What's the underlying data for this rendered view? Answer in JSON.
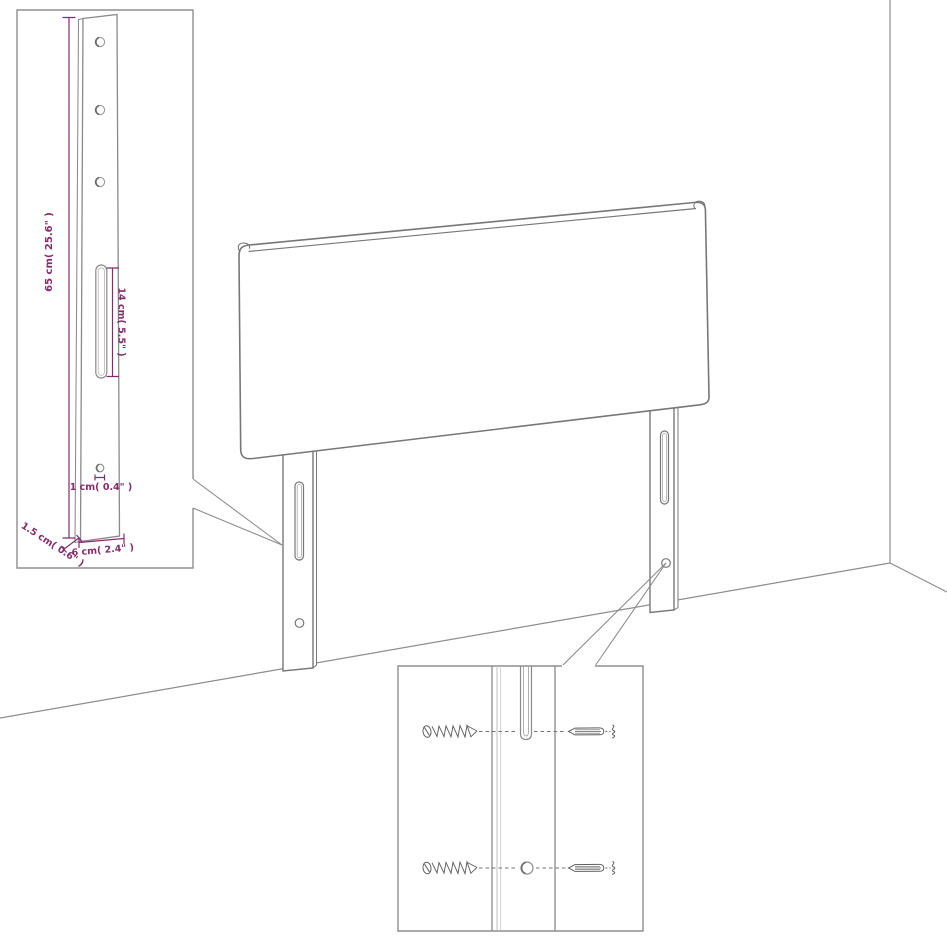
{
  "page": {
    "background": "#ffffff",
    "subject": "headboard-mounting-diagram"
  },
  "colors": {
    "drawing_line": "#777777",
    "wall_line": "#8d8d8d",
    "inset_border": "#8f8f8f",
    "dimension_accent": "#852c6d",
    "hardware_line": "#5f5f5f"
  },
  "main_view": {
    "part_names": [
      "headboard-panel",
      "left-mounting-leg",
      "right-mounting-leg",
      "wall-corner",
      "floor-line"
    ]
  },
  "leg_detail": {
    "labels": {
      "height": "65 cm( 25.6\" )",
      "slot": "14 cm( 5.5\" )",
      "hole": "1 cm( 0.4\" )",
      "depth": "1.5 cm( 0.6\" )",
      "width": "6 cm( 2.4\" )"
    },
    "feature_names": [
      "screw-hole-top",
      "screw-hole-middle",
      "screw-hole-bottom",
      "adjustment-slot",
      "small-hole"
    ]
  },
  "hardware_detail": {
    "item_names": [
      "wood-screw-top",
      "wood-screw-bottom",
      "wall-plug-top",
      "wall-plug-bottom",
      "leg-strip",
      "leg-slot",
      "leg-hole"
    ]
  }
}
